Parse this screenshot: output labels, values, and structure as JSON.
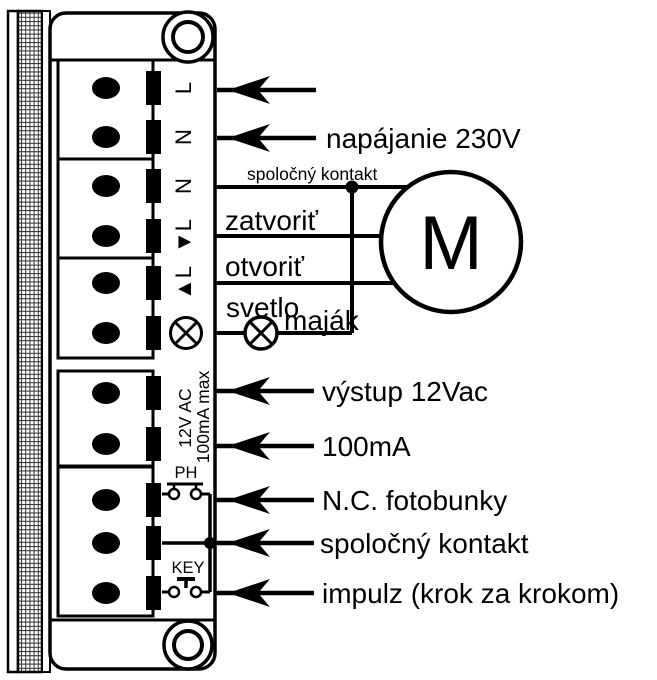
{
  "unit": {
    "terminal_labels": [
      "L",
      "N",
      "N",
      "▼L",
      "▲L"
    ],
    "aux_output_line1": "12V AC",
    "aux_output_line2": "100mA max",
    "photocell_contact_label": "PH",
    "key_contact_label": "KEY"
  },
  "motor": {
    "label": "M"
  },
  "annotations": {
    "power": "napájanie 230V",
    "common_top": "spoločný kontakt",
    "close": "zatvoriť",
    "open": "otvoriť",
    "light": "svetlo",
    "beacon": "maják",
    "output_12vac": "výstup 12Vac",
    "output_100ma": "100mA",
    "nc_photocells": "N.C. fotobunky",
    "common_bottom": "spoločný kontakt",
    "impulse": "impulz (krok za krokom)"
  },
  "colors": {
    "ink": "#000000",
    "paper": "#ffffff"
  }
}
